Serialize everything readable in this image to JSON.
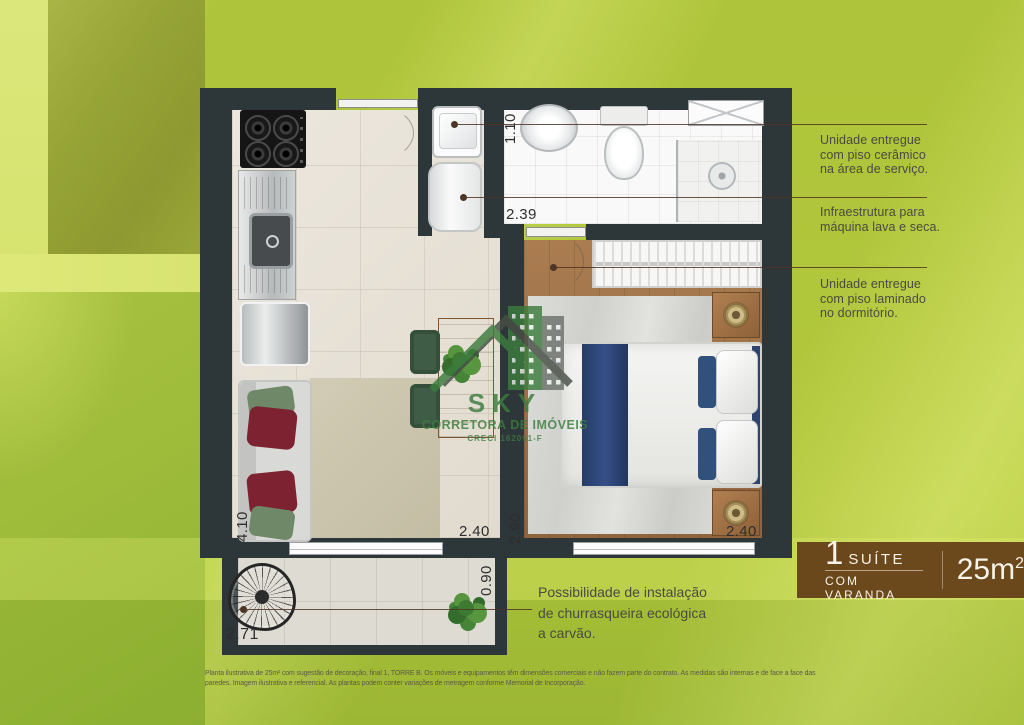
{
  "plan": {
    "dimensions": {
      "bathroom_width": "1.10",
      "bathroom_length": "2.39",
      "living_length": "4.10",
      "living_width": "2.40",
      "bedroom_length": "2.90",
      "bedroom_width": "2.40",
      "balcony_depth": "0.90",
      "balcony_width": "2.71"
    }
  },
  "notes": {
    "side": [
      {
        "lines": [
          "Unidade entregue",
          "com piso cerâmico",
          "na área de serviço."
        ]
      },
      {
        "lines": [
          "Infraestrutura para",
          "máquina lava e seca."
        ]
      },
      {
        "lines": [
          "Unidade entregue",
          "com piso laminado",
          "no dormitório."
        ]
      }
    ],
    "balcony": {
      "lines": [
        "Possibilidade de instalação",
        "de churrasqueira ecológica",
        "a carvão."
      ]
    }
  },
  "badge": {
    "number": "1",
    "type": "SUÍTE",
    "subtitle": "COM VARANDA",
    "area_value": "25m",
    "area_exponent": "2"
  },
  "watermark": {
    "brand": "SKY",
    "tagline": "CORRETORA DE IMÓVEIS",
    "license": "CRECI 162091-F"
  },
  "disclaimer": {
    "lines": [
      "Planta ilustrativa de 25m² com sugestão de decoração, final 1, TORRE B. Os móveis e equipamentos têm dimensões comerciais e não fazem parte do contrato. As medidas são internas e de face a face das",
      "paredes. Imagem ilustrativa e referencial. As plantas podem conter variações de metragem conforme Memorial de Incorporação."
    ]
  },
  "colors": {
    "background": "#b2c73c",
    "highlight": "#dde879",
    "wall": "#2d3639",
    "leader_line": "#4d3525",
    "badge_background": "#633c17",
    "logo_green": "#3c7c3e"
  }
}
